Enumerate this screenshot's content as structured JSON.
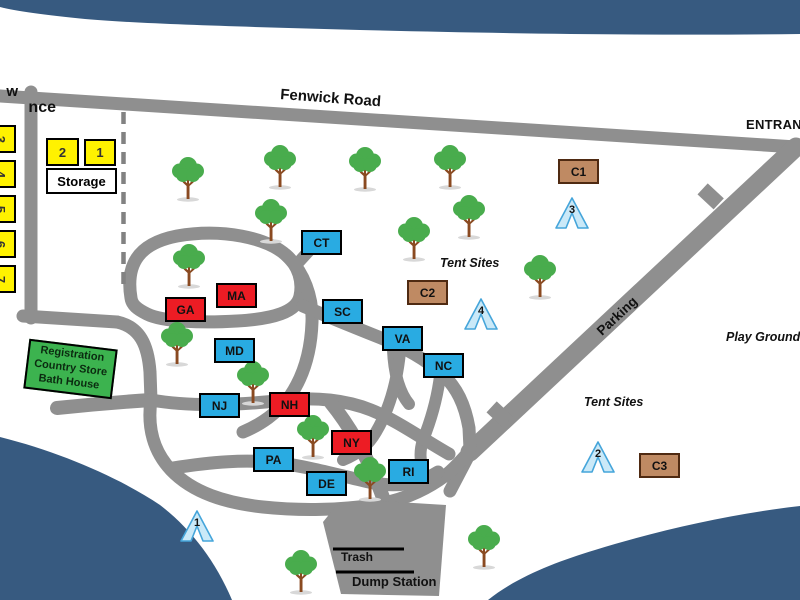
{
  "road_labels": {
    "fenwick": "Fenwick Road",
    "entrance": "ENTRANCE",
    "parking": "Parking"
  },
  "area_labels": {
    "tent_sites_upper": "Tent Sites",
    "tent_sites_lower": "Tent Sites",
    "play_ground": "Play Ground",
    "edge_partial_top": "w",
    "edge_partial_bottom": "nce"
  },
  "facilities": {
    "registration_lines": [
      "Registration",
      "Country Store",
      "Bath House"
    ],
    "storage_label": "Storage",
    "trash_label": "Trash",
    "dump_label": "Dump Station"
  },
  "storage_sites": [
    {
      "num": "2",
      "x": 46,
      "y": 138,
      "w": 33,
      "h": 28
    },
    {
      "num": "1",
      "x": 84,
      "y": 139,
      "w": 32,
      "h": 27
    }
  ],
  "left_sites": [
    {
      "num": "3",
      "y": 125
    },
    {
      "num": "4",
      "y": 160
    },
    {
      "num": "5",
      "y": 195
    },
    {
      "num": "6",
      "y": 230
    },
    {
      "num": "7",
      "y": 265
    }
  ],
  "cabins": [
    {
      "id": "CT",
      "type": "blue",
      "x": 301,
      "y": 230
    },
    {
      "id": "C1",
      "type": "brown",
      "x": 558,
      "y": 159
    },
    {
      "id": "C2",
      "type": "brown",
      "x": 407,
      "y": 280
    },
    {
      "id": "C3",
      "type": "brown",
      "x": 639,
      "y": 453
    },
    {
      "id": "MA",
      "type": "red",
      "x": 216,
      "y": 283
    },
    {
      "id": "GA",
      "type": "red",
      "x": 165,
      "y": 297
    },
    {
      "id": "SC",
      "type": "blue",
      "x": 322,
      "y": 299
    },
    {
      "id": "VA",
      "type": "blue",
      "x": 382,
      "y": 326
    },
    {
      "id": "NC",
      "type": "blue",
      "x": 423,
      "y": 353
    },
    {
      "id": "MD",
      "type": "blue",
      "x": 214,
      "y": 338
    },
    {
      "id": "NJ",
      "type": "blue",
      "x": 199,
      "y": 393
    },
    {
      "id": "NH",
      "type": "red",
      "x": 269,
      "y": 392
    },
    {
      "id": "NY",
      "type": "red",
      "x": 331,
      "y": 430
    },
    {
      "id": "PA",
      "type": "blue",
      "x": 253,
      "y": 447
    },
    {
      "id": "DE",
      "type": "blue",
      "x": 306,
      "y": 471
    },
    {
      "id": "RI",
      "type": "blue",
      "x": 388,
      "y": 459
    }
  ],
  "tents": [
    {
      "num": "3",
      "x": 555,
      "y": 197
    },
    {
      "num": "4",
      "x": 464,
      "y": 298
    },
    {
      "num": "2",
      "x": 581,
      "y": 441
    },
    {
      "num": "1",
      "x": 180,
      "y": 510
    }
  ],
  "trees": [
    [
      188,
      200
    ],
    [
      280,
      188
    ],
    [
      365,
      190
    ],
    [
      450,
      188
    ],
    [
      271,
      242
    ],
    [
      414,
      260
    ],
    [
      469,
      238
    ],
    [
      540,
      298
    ],
    [
      189,
      287
    ],
    [
      177,
      365
    ],
    [
      253,
      404
    ],
    [
      313,
      458
    ],
    [
      370,
      500
    ],
    [
      301,
      593
    ],
    [
      484,
      568
    ]
  ],
  "colors": {
    "road": "#8f8f8f",
    "water": "#375a80",
    "blue": "#29abe2",
    "red": "#ed1c24",
    "brown": "#bf8a63",
    "brown_border": "#4f2a12",
    "yellow": "#fff200",
    "registration_green": "#3cb34f",
    "tent_fill": "#cae9f8",
    "tent_stroke": "#45a5da",
    "tree_green": "#49ac4d",
    "trunk_brown": "#8a4a21"
  }
}
